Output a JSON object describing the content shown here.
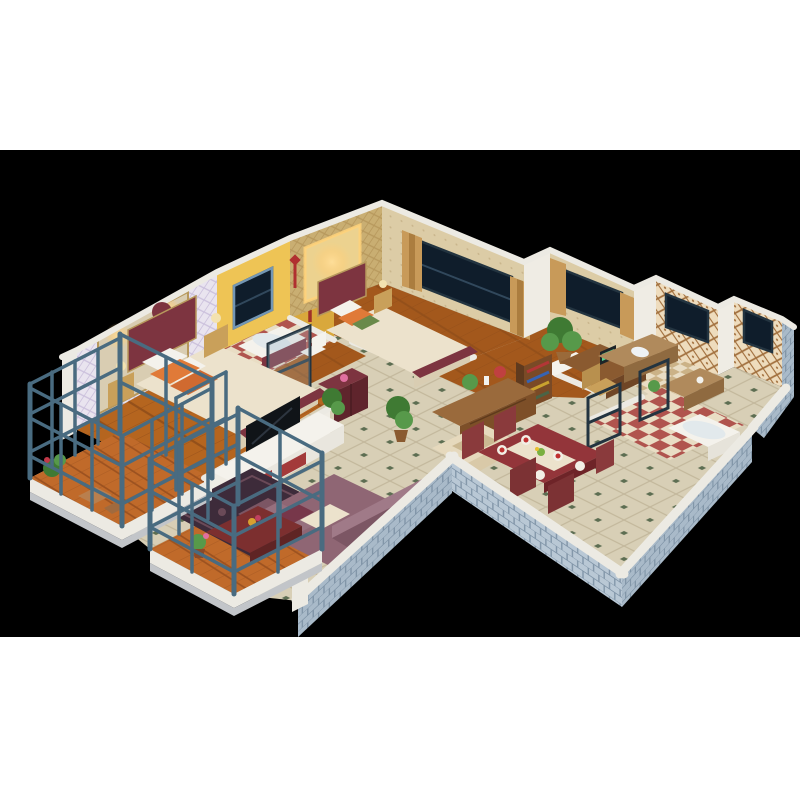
{
  "canvas": {
    "background": "#ffffff",
    "stage_background": "#000000",
    "stage_top_px": 150,
    "stage_height_px": 487
  },
  "colors": {
    "wood": "#b5651f",
    "woodDark": "#94501a",
    "wood2": "#a3581c",
    "plank": "#c06a2a",
    "plankDark": "#9c5220",
    "tile": "#d8cfb6",
    "tileLine": "#c2b79b",
    "tileDot": "#5d6e52",
    "brick": "#a9bac9",
    "brickLight": "#b9c8d5",
    "brickLine": "#8195a8",
    "ledge": "#eceae3",
    "ledgeShade": "#c2c5c9",
    "wallWhite": "#efece4",
    "lilac": "#e9e4ef",
    "lilacLine": "#c9bedb",
    "stone": "#d9cdb2",
    "yellow": "#eec455",
    "yellowDark": "#d9a83c",
    "gold": "#c9ae72",
    "goldLine": "#b7985c",
    "goldLight": "#ecd28f",
    "wallpaper": "#dccca6",
    "wallpaper2": "#e4d6b2",
    "wallpaperDot": "#c9b58c",
    "latticeBg": "#eedcbd",
    "latticeLine": "#a2703e",
    "navy": "#0f1d2b",
    "frameBlue": "#7396b4",
    "frameDark": "#233440",
    "curtain": "#c89a59",
    "curtainDark": "#ab7d3f",
    "slate": "#496b80",
    "slateLight": "#5d8297",
    "maroon": "#7d3440",
    "maroonDark": "#5f242c",
    "mauve": "#8f6674",
    "mauveDark": "#7c5664",
    "cream": "#ece2cc",
    "creamDark": "#d9cdb2",
    "orange": "#e07a38",
    "orange2": "#d06a30",
    "tableRed": "#93353a",
    "tableRedDark": "#6e2428",
    "brown": "#8a5a30",
    "brownDark": "#6f4525",
    "shelfBrown": "#7a4a26",
    "green": "#3f7a33",
    "greenLight": "#57994a",
    "checkerRed": "#b0544e",
    "checkerCream": "#e9ddc4",
    "mosaic": "#cbb287",
    "white": "#f4f2ec",
    "rug": "#3d2b3a",
    "rugLine": "#6a4a58",
    "glow": "#ffd27a",
    "shower": "#a03028",
    "laptopScreen": "#5ad08a",
    "redAccent": "#b03030",
    "flowerPink": "#e070a0"
  },
  "scene": {
    "type": "3d-isometric-apartment-cutaway-render",
    "projection": "isometric-cutaway",
    "outer_walls": "light-blue-gray brick with white top ledges",
    "rooms": [
      {
        "name": "master-bedroom",
        "floor": "wood",
        "features": [
          "lilac-diamond-wallpaper",
          "stone-accent-wall",
          "wall-sconces"
        ],
        "furniture": [
          "maroon-double-bed",
          "cream-bedding",
          "orange-pillows",
          "nightstands-with-lamps"
        ]
      },
      {
        "name": "bathroom-1",
        "floor": "red-white-checker-tile",
        "features": [
          "yellow-walls",
          "window",
          "red-shower-fixture",
          "glass-door"
        ],
        "furniture": [
          "bathtub",
          "toilet",
          "maroon-vanity"
        ]
      },
      {
        "name": "bedroom-2",
        "floor": "wood",
        "features": [
          "gold-wallpaper",
          "lit-wall-niche",
          "navy-window",
          "tan-curtains"
        ],
        "furniture": [
          "maroon-double-bed",
          "nightstand"
        ]
      },
      {
        "name": "study",
        "floor": "wood",
        "features": [
          "navy-window",
          "tan-curtains"
        ],
        "furniture": [
          "desk",
          "laptop",
          "chair",
          "bookshelf",
          "potted-plant"
        ]
      },
      {
        "name": "kitchen",
        "floor": "mosaic-tile",
        "features": [
          "lattice-tile-walls",
          "navy-windows"
        ],
        "furniture": [
          "counters",
          "sink"
        ]
      },
      {
        "name": "bathroom-2",
        "floor": "red-cream-checker-tile",
        "features": [
          "lattice-tile-walls",
          "navy-window",
          "glass-partitions"
        ],
        "furniture": [
          "bathtub"
        ]
      },
      {
        "name": "living-room",
        "floor": "beige-tile-green-diamond-accents",
        "furniture": [
          "mauve-l-sofa",
          "dark-red-coffee-table",
          "patterned-rug",
          "white-red-tv-stand",
          "flat-tv",
          "floor-plant",
          "cream-armchair",
          "sideboard-with-plants"
        ]
      },
      {
        "name": "dining-room",
        "floor": "beige-tile-green-diamond-accents",
        "furniture": [
          "red-dining-table",
          "white-runner",
          "place-settings",
          "four-red-chairs"
        ]
      },
      {
        "name": "balcony-left",
        "floor": "orange-wood-planks",
        "features": [
          "slate-steel-railing",
          "white-base-ledge"
        ],
        "furniture": [
          "potted-plants",
          "small-table",
          "stool"
        ]
      },
      {
        "name": "balcony-front",
        "floor": "orange-wood-planks",
        "features": [
          "slate-steel-railing",
          "white-base-ledge"
        ],
        "furniture": [
          "potted-plant"
        ]
      }
    ]
  }
}
